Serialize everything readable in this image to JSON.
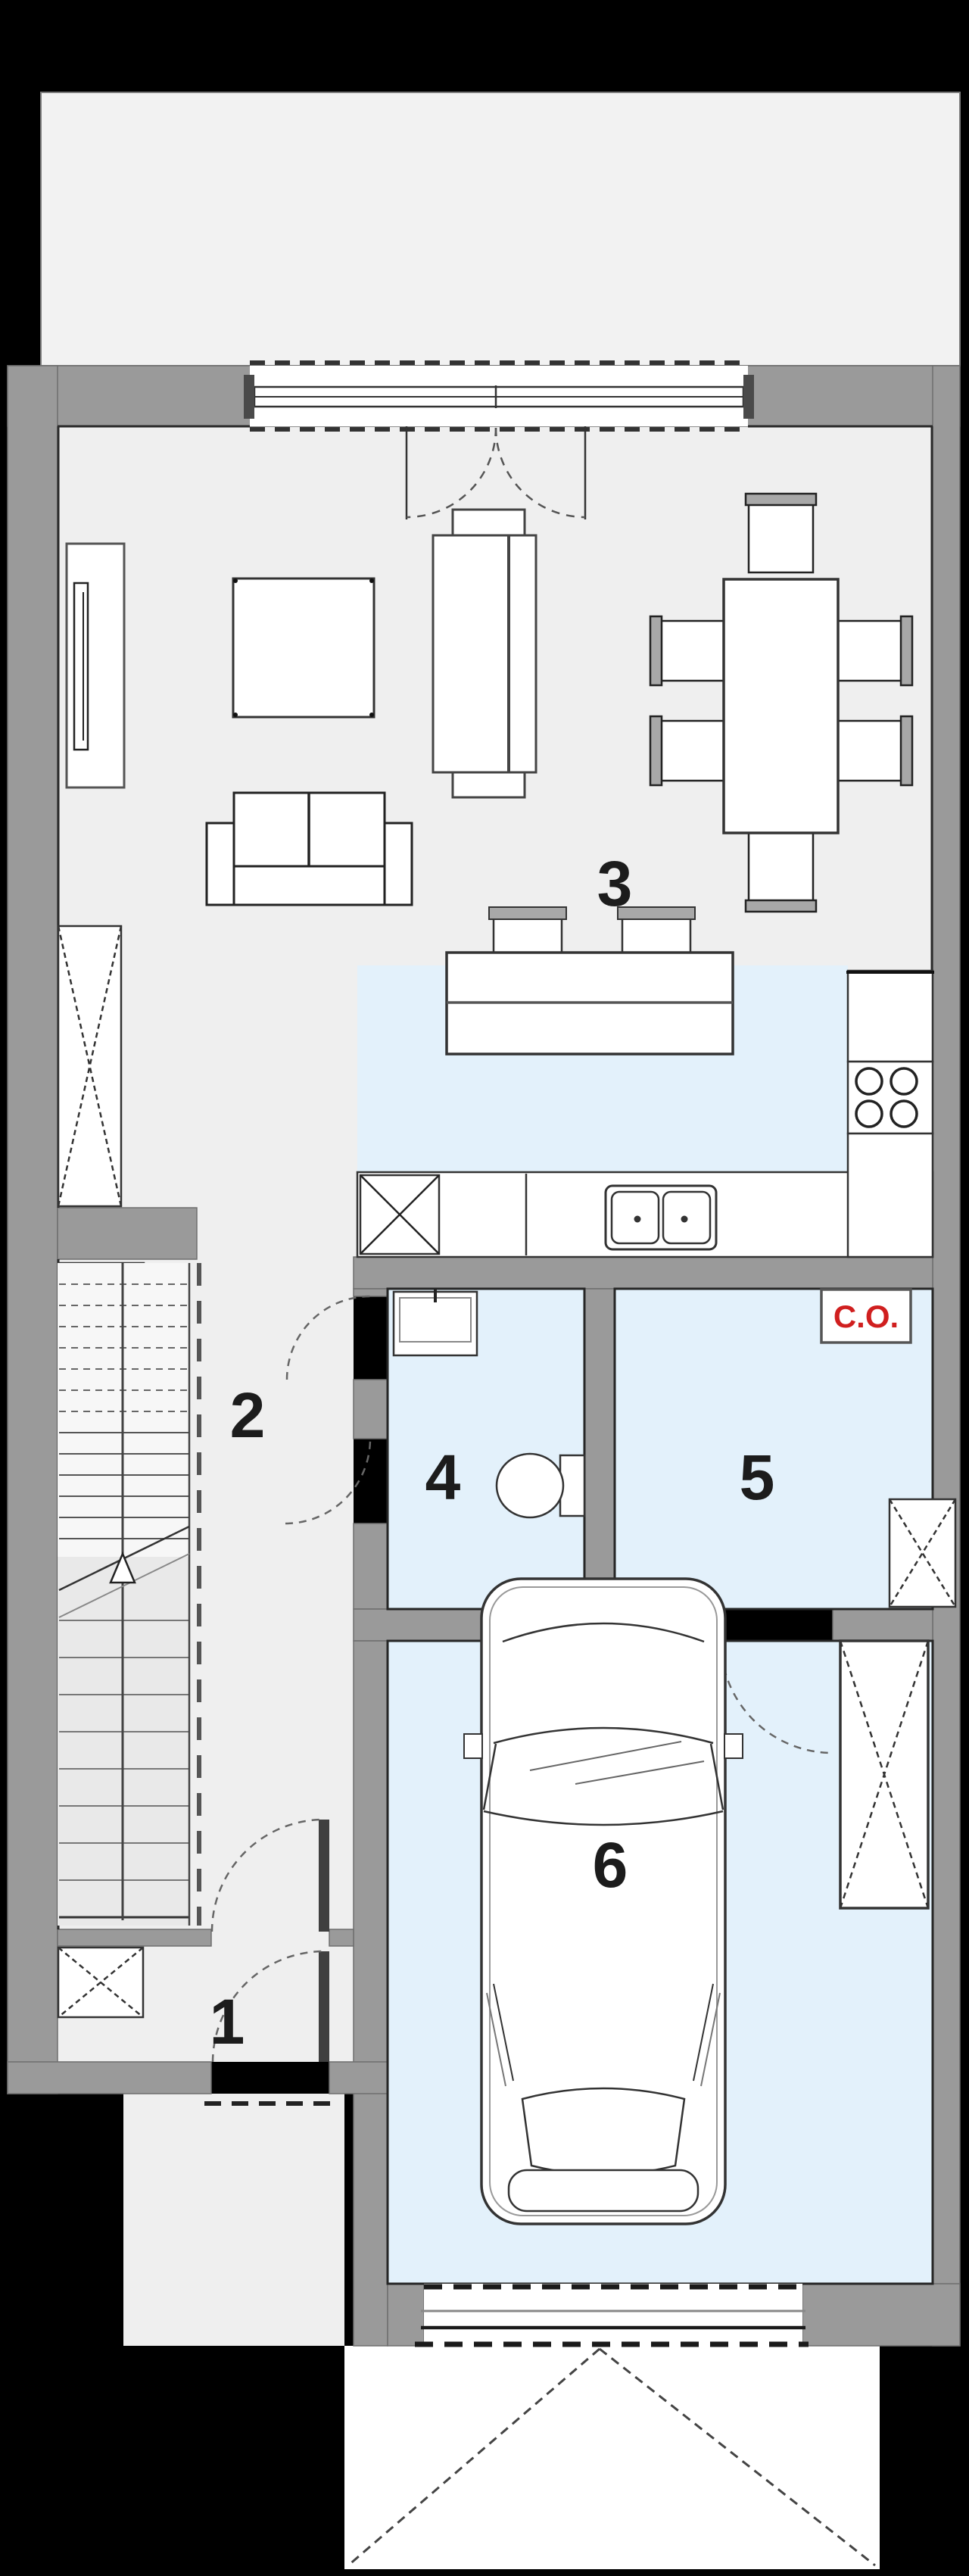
{
  "floor_plan": {
    "room_labels": [
      "1",
      "2",
      "3",
      "4",
      "5",
      "6"
    ],
    "boiler_label": "C.O.",
    "colors": {
      "background": "#000000",
      "wall_gray": "#9a9a9a",
      "floor_light": "#efefef",
      "terrace_light": "#f2f2f2",
      "wet_room_blue": "#e3f1fb",
      "line_dark": "#222222",
      "boiler_red": "#d01f1f"
    }
  }
}
